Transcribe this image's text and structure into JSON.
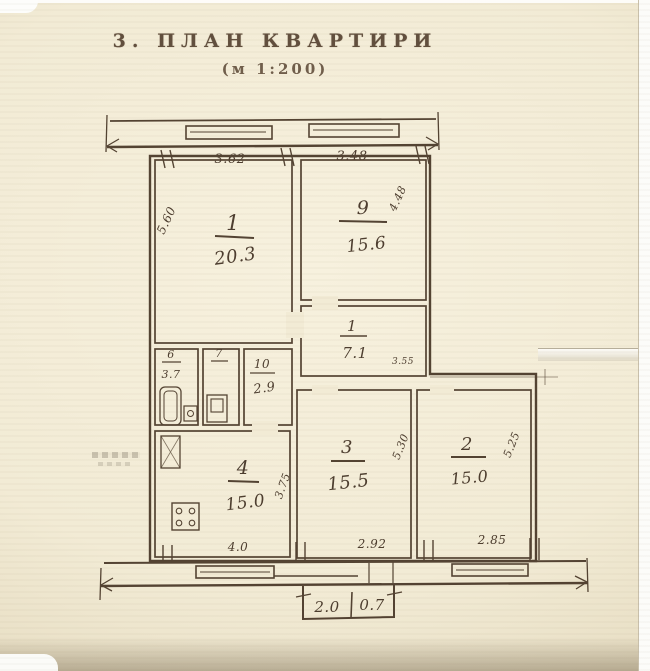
{
  "document": {
    "title": "3.  ПЛАН  КВАРТИРИ",
    "scale_note": "(м 1:200)"
  },
  "plan": {
    "rooms": {
      "living1": {
        "number": "1",
        "area": "20.3"
      },
      "living9": {
        "number": "9",
        "area": "15.6"
      },
      "hall": {
        "number": "1",
        "area": "7.1"
      },
      "bath": {
        "number": "6",
        "area": "3.7"
      },
      "wc": {
        "number": "7"
      },
      "corridor": {
        "number": "10",
        "area": "2.9"
      },
      "kitchen": {
        "number": "4",
        "area": "15.0"
      },
      "living3": {
        "number": "3",
        "area": "15.5"
      },
      "living2": {
        "number": "2",
        "area": "15.0"
      }
    },
    "dimensions": {
      "top_left_width": "3.62",
      "top_right_width": "3.48",
      "living1_depth": "5.60",
      "living9_depth": "4.48",
      "hall_width": "3.55",
      "kitchen_depth": "3.75",
      "living3_depth": "5.30",
      "living2_depth": "5.25",
      "bottom_kitchen_width": "4.0",
      "bottom_living3_width": "2.92",
      "bottom_living2_width": "2.85",
      "balcony_width": "2.0",
      "balcony_depth": "0.7"
    },
    "icons": {
      "bathtub": "bathtub-icon",
      "toilet": "toilet-icon",
      "sink": "sink-icon",
      "stove": "stove-icon"
    },
    "ink_color": "#4b3a2a",
    "paper_color": "#f2ebd5"
  }
}
